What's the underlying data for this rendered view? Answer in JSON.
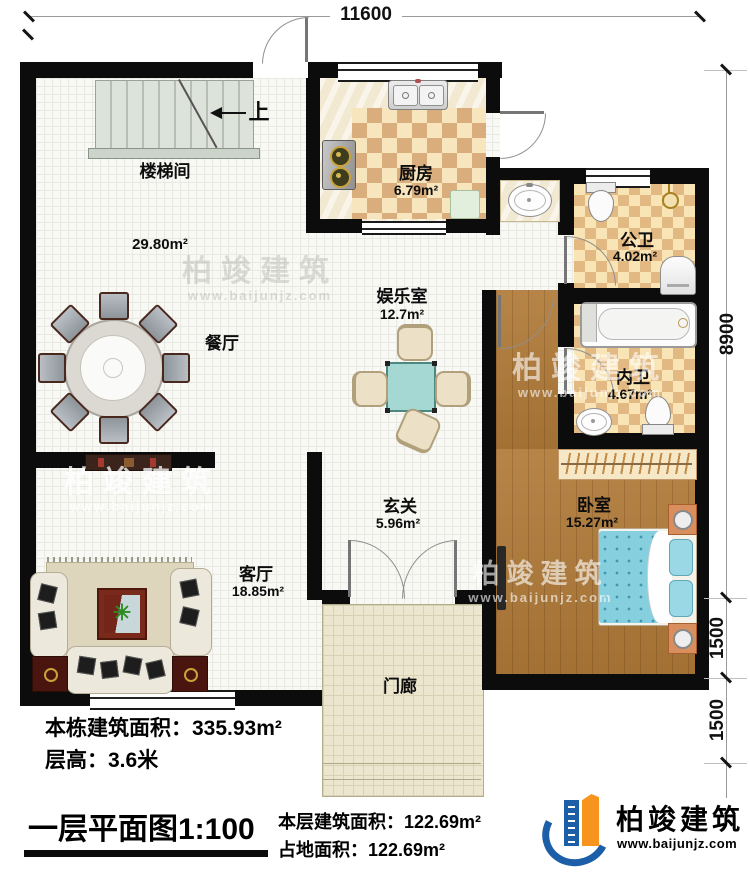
{
  "plan_title": "一层平面图1:100",
  "dimensions": {
    "top_width": "11600",
    "right_height": "8900",
    "right_lower1": "1500",
    "right_lower2": "1500"
  },
  "stairs": {
    "direction_label": "上"
  },
  "rooms": {
    "stairwell": {
      "name": "楼梯间"
    },
    "dining": {
      "name": "餐厅",
      "area": "29.80m²"
    },
    "kitchen": {
      "name": "厨房",
      "area": "6.79m²"
    },
    "entertainment": {
      "name": "娱乐室",
      "area": "12.7m²"
    },
    "public_bath": {
      "name": "公卫",
      "area": "4.02m²"
    },
    "inner_bath": {
      "name": "内卫",
      "area": "4.67m²"
    },
    "bedroom": {
      "name": "卧室",
      "area": "15.27m²"
    },
    "foyer": {
      "name": "玄关",
      "area": "5.96m²"
    },
    "living": {
      "name": "客厅",
      "area": "18.85m²"
    },
    "porch": {
      "name": "门廊"
    }
  },
  "info": {
    "building_area": "本栋建筑面积：335.93m²",
    "floor_height": "层高：3.6米"
  },
  "floor_stats": {
    "floor_area": "本层建筑面积：122.69m²",
    "footprint": "占地面积：122.69m²"
  },
  "brand": {
    "name": "柏竣建筑",
    "website": "www.baijunjz.com"
  },
  "watermark": {
    "name": "柏竣建筑",
    "website": "www.baijunjz.com"
  },
  "colors": {
    "wall": "#0c0c0c",
    "wood_floor": "#b07a38",
    "checker_tan": "#d9ae7c",
    "bed_blue": "#86cfdf",
    "brand_blue": "#1c5fa8",
    "brand_orange": "#f7941d"
  }
}
